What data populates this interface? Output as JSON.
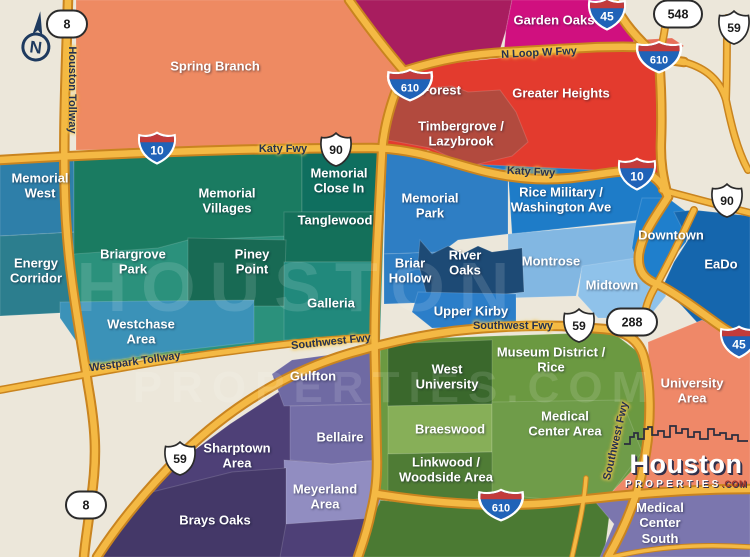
{
  "map": {
    "colors": {
      "background": "#ece7da",
      "road": "#f4b944",
      "road_casing": "#c9841f",
      "road_label": "#25314f",
      "interstate_blue": "#2063b8",
      "interstate_red": "#c23b3b",
      "shield_white": "#ffffff"
    },
    "base_fills": {
      "bottom_green": "#4b7a33",
      "red_sliver": "#e8705a"
    },
    "compass": {
      "letter": "N"
    },
    "watermark": {
      "line1": "HOUSTON",
      "line2": "PROPERTIES.COM"
    },
    "logo": {
      "brand": "Houston",
      "brand_sub": "PROPERTIES",
      "brand_tld": ".COM"
    },
    "regions": [
      {
        "id": "spring-branch",
        "label": "Spring Branch",
        "color": "#ee8a62"
      },
      {
        "id": "oak-forest",
        "label": "Oak Forest",
        "color": "#a81d5f"
      },
      {
        "id": "garden-oaks",
        "label": "Garden Oaks",
        "color": "#d0107f"
      },
      {
        "id": "greater-heights",
        "label": "Greater Heights",
        "color": "#e33b2e"
      },
      {
        "id": "timbergrove-lazybrook",
        "label": "Timbergrove /\nLazybrook",
        "color": "#b24a3e"
      },
      {
        "id": "memorial-west",
        "label": "Memorial\nWest",
        "color": "#2e7fa9"
      },
      {
        "id": "energy-corridor",
        "label": "Energy\nCorridor",
        "color": "#2c7e8e"
      },
      {
        "id": "memorial-villages",
        "label": "Memorial\nVillages",
        "color": "#1a7b61"
      },
      {
        "id": "memorial-close-in",
        "label": "Memorial\nClose In",
        "color": "#0f6f5f"
      },
      {
        "id": "tanglewood",
        "label": "Tanglewood",
        "color": "#14705a"
      },
      {
        "id": "piney-point",
        "label": "Piney\nPoint",
        "color": "#186a54"
      },
      {
        "id": "briargrove-park",
        "label": "Briargrove\nPark",
        "color": "#2b917c"
      },
      {
        "id": "galleria",
        "label": "Galleria",
        "color": "#21897c"
      },
      {
        "id": "westchase-area",
        "label": "Westchase\nArea",
        "color": "#3b92b8"
      },
      {
        "id": "memorial-park",
        "label": "Memorial\nPark",
        "color": "#2e7ec4"
      },
      {
        "id": "rice-military",
        "label": "Rice Military  /\nWashington Ave",
        "color": "#1e7cc8"
      },
      {
        "id": "briar-hollow",
        "label": "Briar\nHollow",
        "color": "#2e7ec4"
      },
      {
        "id": "river-oaks",
        "label": "River\nOaks",
        "color": "#1d4a75"
      },
      {
        "id": "montrose",
        "label": "Montrose",
        "color": "#82b7e2"
      },
      {
        "id": "midtown",
        "label": "Midtown",
        "color": "#8fc2ea"
      },
      {
        "id": "upper-kirby",
        "label": "Upper Kirby",
        "color": "#2b7ec9"
      },
      {
        "id": "downtown",
        "label": "Downtown",
        "color": "#1f7fcc"
      },
      {
        "id": "eado",
        "label": "EaDo",
        "color": "#1566ad"
      },
      {
        "id": "university-area",
        "label": "University Area",
        "color": "#ef8868"
      },
      {
        "id": "west-university",
        "label": "West\nUniversity",
        "color": "#3a682c"
      },
      {
        "id": "museum-district-rice",
        "label": "Museum District /\nRice",
        "color": "#6b9941"
      },
      {
        "id": "braeswood",
        "label": "Braeswood",
        "color": "#87af58"
      },
      {
        "id": "medical-center-area",
        "label": "Medical\nCenter Area",
        "color": "#6f9c49"
      },
      {
        "id": "linkwood-woodside",
        "label": "Linkwood /\nWoodside Area",
        "color": "#4f7c35"
      },
      {
        "id": "gulfton",
        "label": "Gulfton",
        "color": "#6f6aa3"
      },
      {
        "id": "bellaire",
        "label": "Bellaire",
        "color": "#746ea7"
      },
      {
        "id": "meyerland-area",
        "label": "Meyerland\nArea",
        "color": "#918dc1"
      },
      {
        "id": "sharpstown-area",
        "label": "Sharptown\nArea",
        "color": "#4e4077"
      },
      {
        "id": "brays-oaks",
        "label": "Brays Oaks",
        "color": "#443868"
      },
      {
        "id": "medical-center-south",
        "label": "Medical Center\nSouth",
        "color": "#7b76ae"
      }
    ],
    "road_labels": [
      {
        "text": "Houston Tollway"
      },
      {
        "text": "Katy Fwy"
      },
      {
        "text": "Katy Fwy"
      },
      {
        "text": "N Loop W Fwy"
      },
      {
        "text": "Southwest Fwy"
      },
      {
        "text": "Southwest Fwy"
      },
      {
        "text": "Westpark Tollway"
      },
      {
        "text": "Southwest Fwy"
      }
    ],
    "shields": [
      {
        "kind": "beltway-oval",
        "number": "8"
      },
      {
        "kind": "interstate",
        "number": "10"
      },
      {
        "kind": "us-route",
        "number": "90"
      },
      {
        "kind": "interstate",
        "number": "610"
      },
      {
        "kind": "interstate",
        "number": "45"
      },
      {
        "kind": "beltway-oval",
        "number": "548"
      },
      {
        "kind": "us-route",
        "number": "59"
      },
      {
        "kind": "interstate",
        "number": "610"
      },
      {
        "kind": "interstate",
        "number": "10"
      },
      {
        "kind": "us-route",
        "number": "90"
      },
      {
        "kind": "us-route",
        "number": "59"
      },
      {
        "kind": "beltway-oval",
        "number": "288"
      },
      {
        "kind": "us-route",
        "number": "59"
      },
      {
        "kind": "beltway-oval",
        "number": "8"
      },
      {
        "kind": "interstate",
        "number": "610"
      },
      {
        "kind": "interstate",
        "number": "45"
      }
    ]
  }
}
